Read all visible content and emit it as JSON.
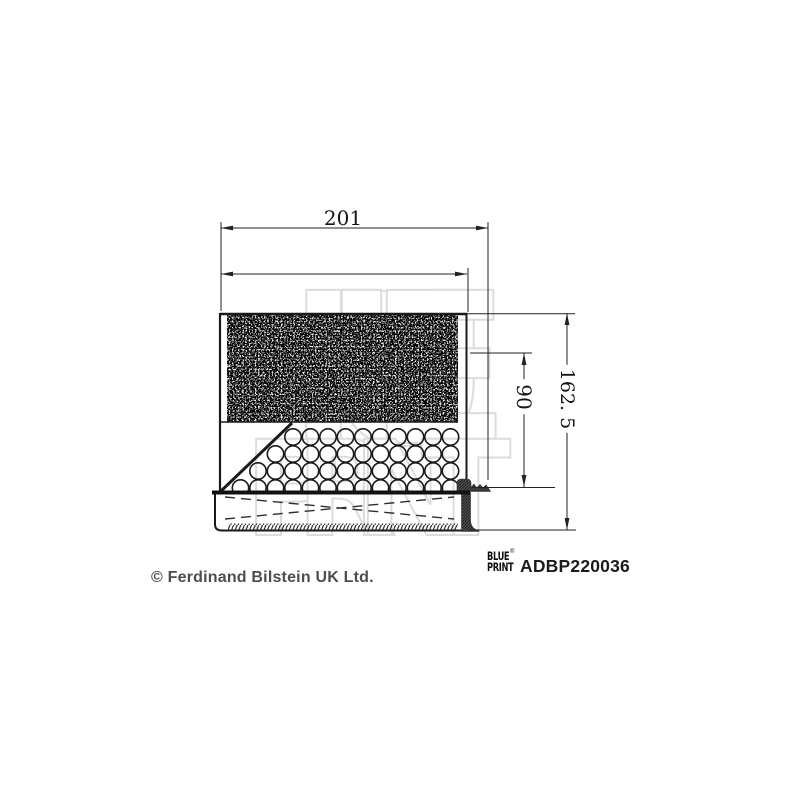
{
  "drawing": {
    "dim_width": "201",
    "dim_inner_height": "90",
    "dim_total_height": "162. 5",
    "watermark_line1": "BLUE",
    "watermark_line2": "PRINT"
  },
  "footer": {
    "copyright": "© Ferdinand Bilstein UK Ltd.",
    "brand_line1": "BLUE",
    "brand_line2": "PRINT",
    "brand_registered": "®",
    "part_number": "ADBP220036"
  },
  "colors": {
    "outline": "#1a1a1a",
    "dimension_line": "#222222",
    "watermark": "#dcdcdc",
    "footer_text": "#4d4d4d",
    "seal_fill": "#4f4f4f"
  }
}
